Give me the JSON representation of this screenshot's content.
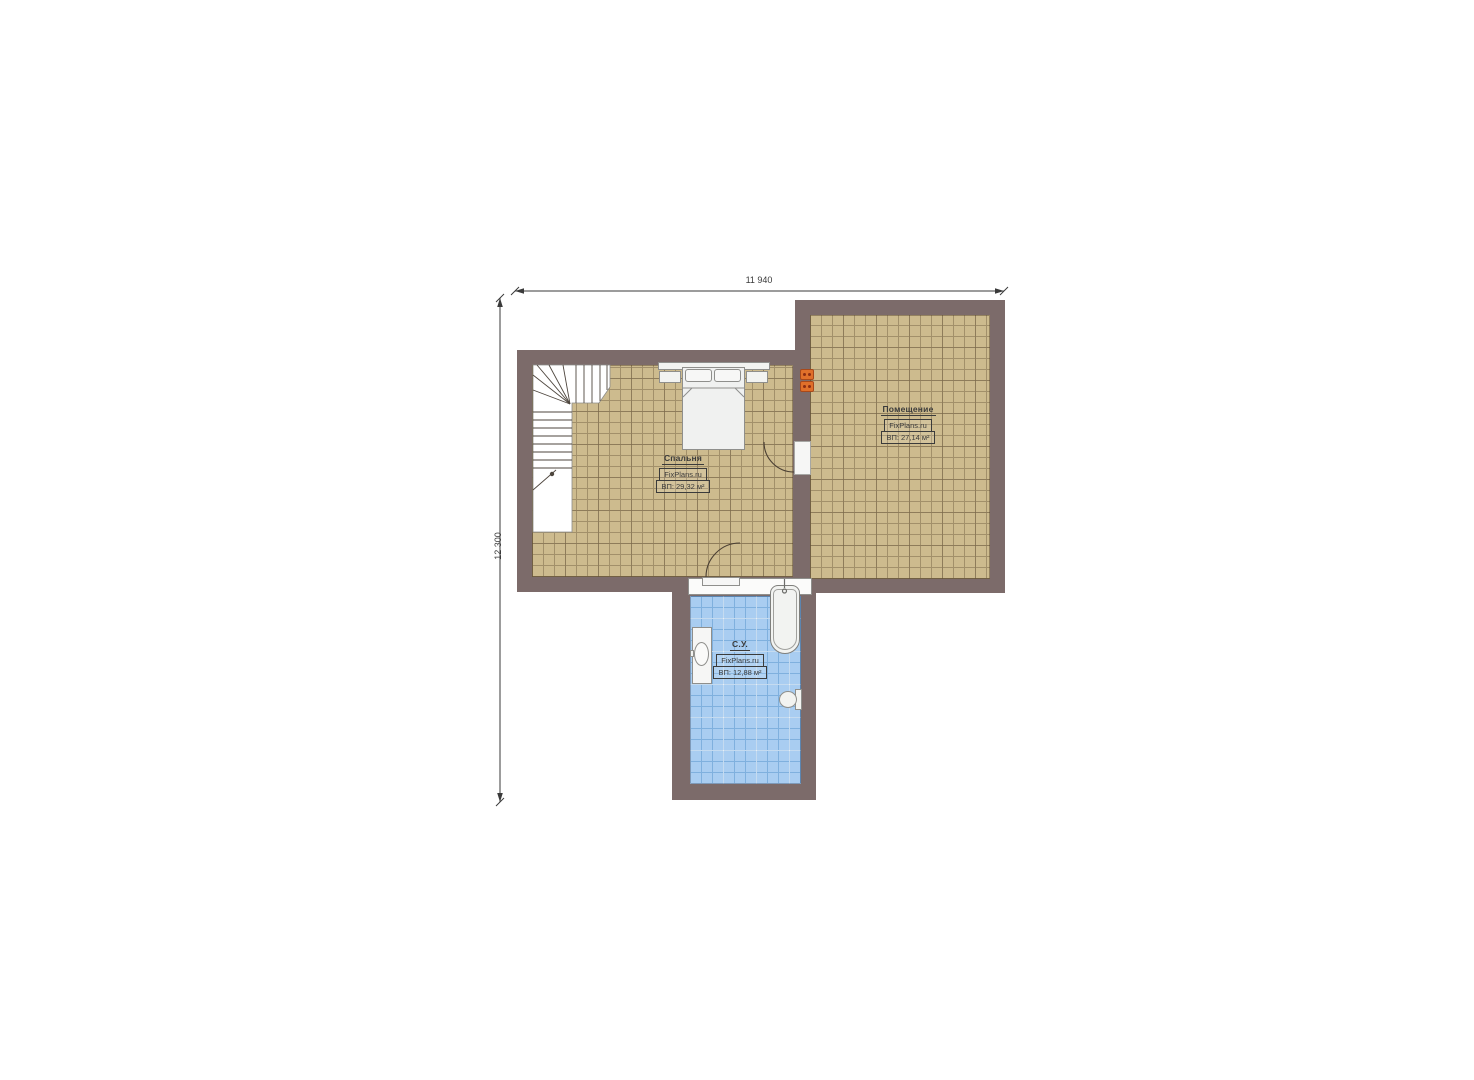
{
  "dimensions": {
    "width_label": "11 940",
    "height_label": "12 300"
  },
  "rooms": [
    {
      "name": "Спальня",
      "watermark": "FixPlans.ru",
      "area_label": "ВП: 29,32 м²"
    },
    {
      "name": "Помещение",
      "watermark": "FixPlans.ru",
      "area_label": "ВП: 27,14 м²"
    },
    {
      "name": "С.У.",
      "watermark": "FixPlans.ru",
      "area_label": "ВП: 12,88 м²"
    }
  ],
  "colors": {
    "wall": "#7c6b6a",
    "floor_tile_tan": "#cdbb8e",
    "floor_tile_tan_grid": "#a2906a",
    "floor_tile_blue": "#a9cdf1",
    "floor_tile_blue_grid": "#7fb0de",
    "fixture_fill": "#f2f3f1",
    "fixture_outline": "#8f8f8c",
    "radiator": "#e0702a",
    "dimension_text": "#3a3a3a"
  }
}
